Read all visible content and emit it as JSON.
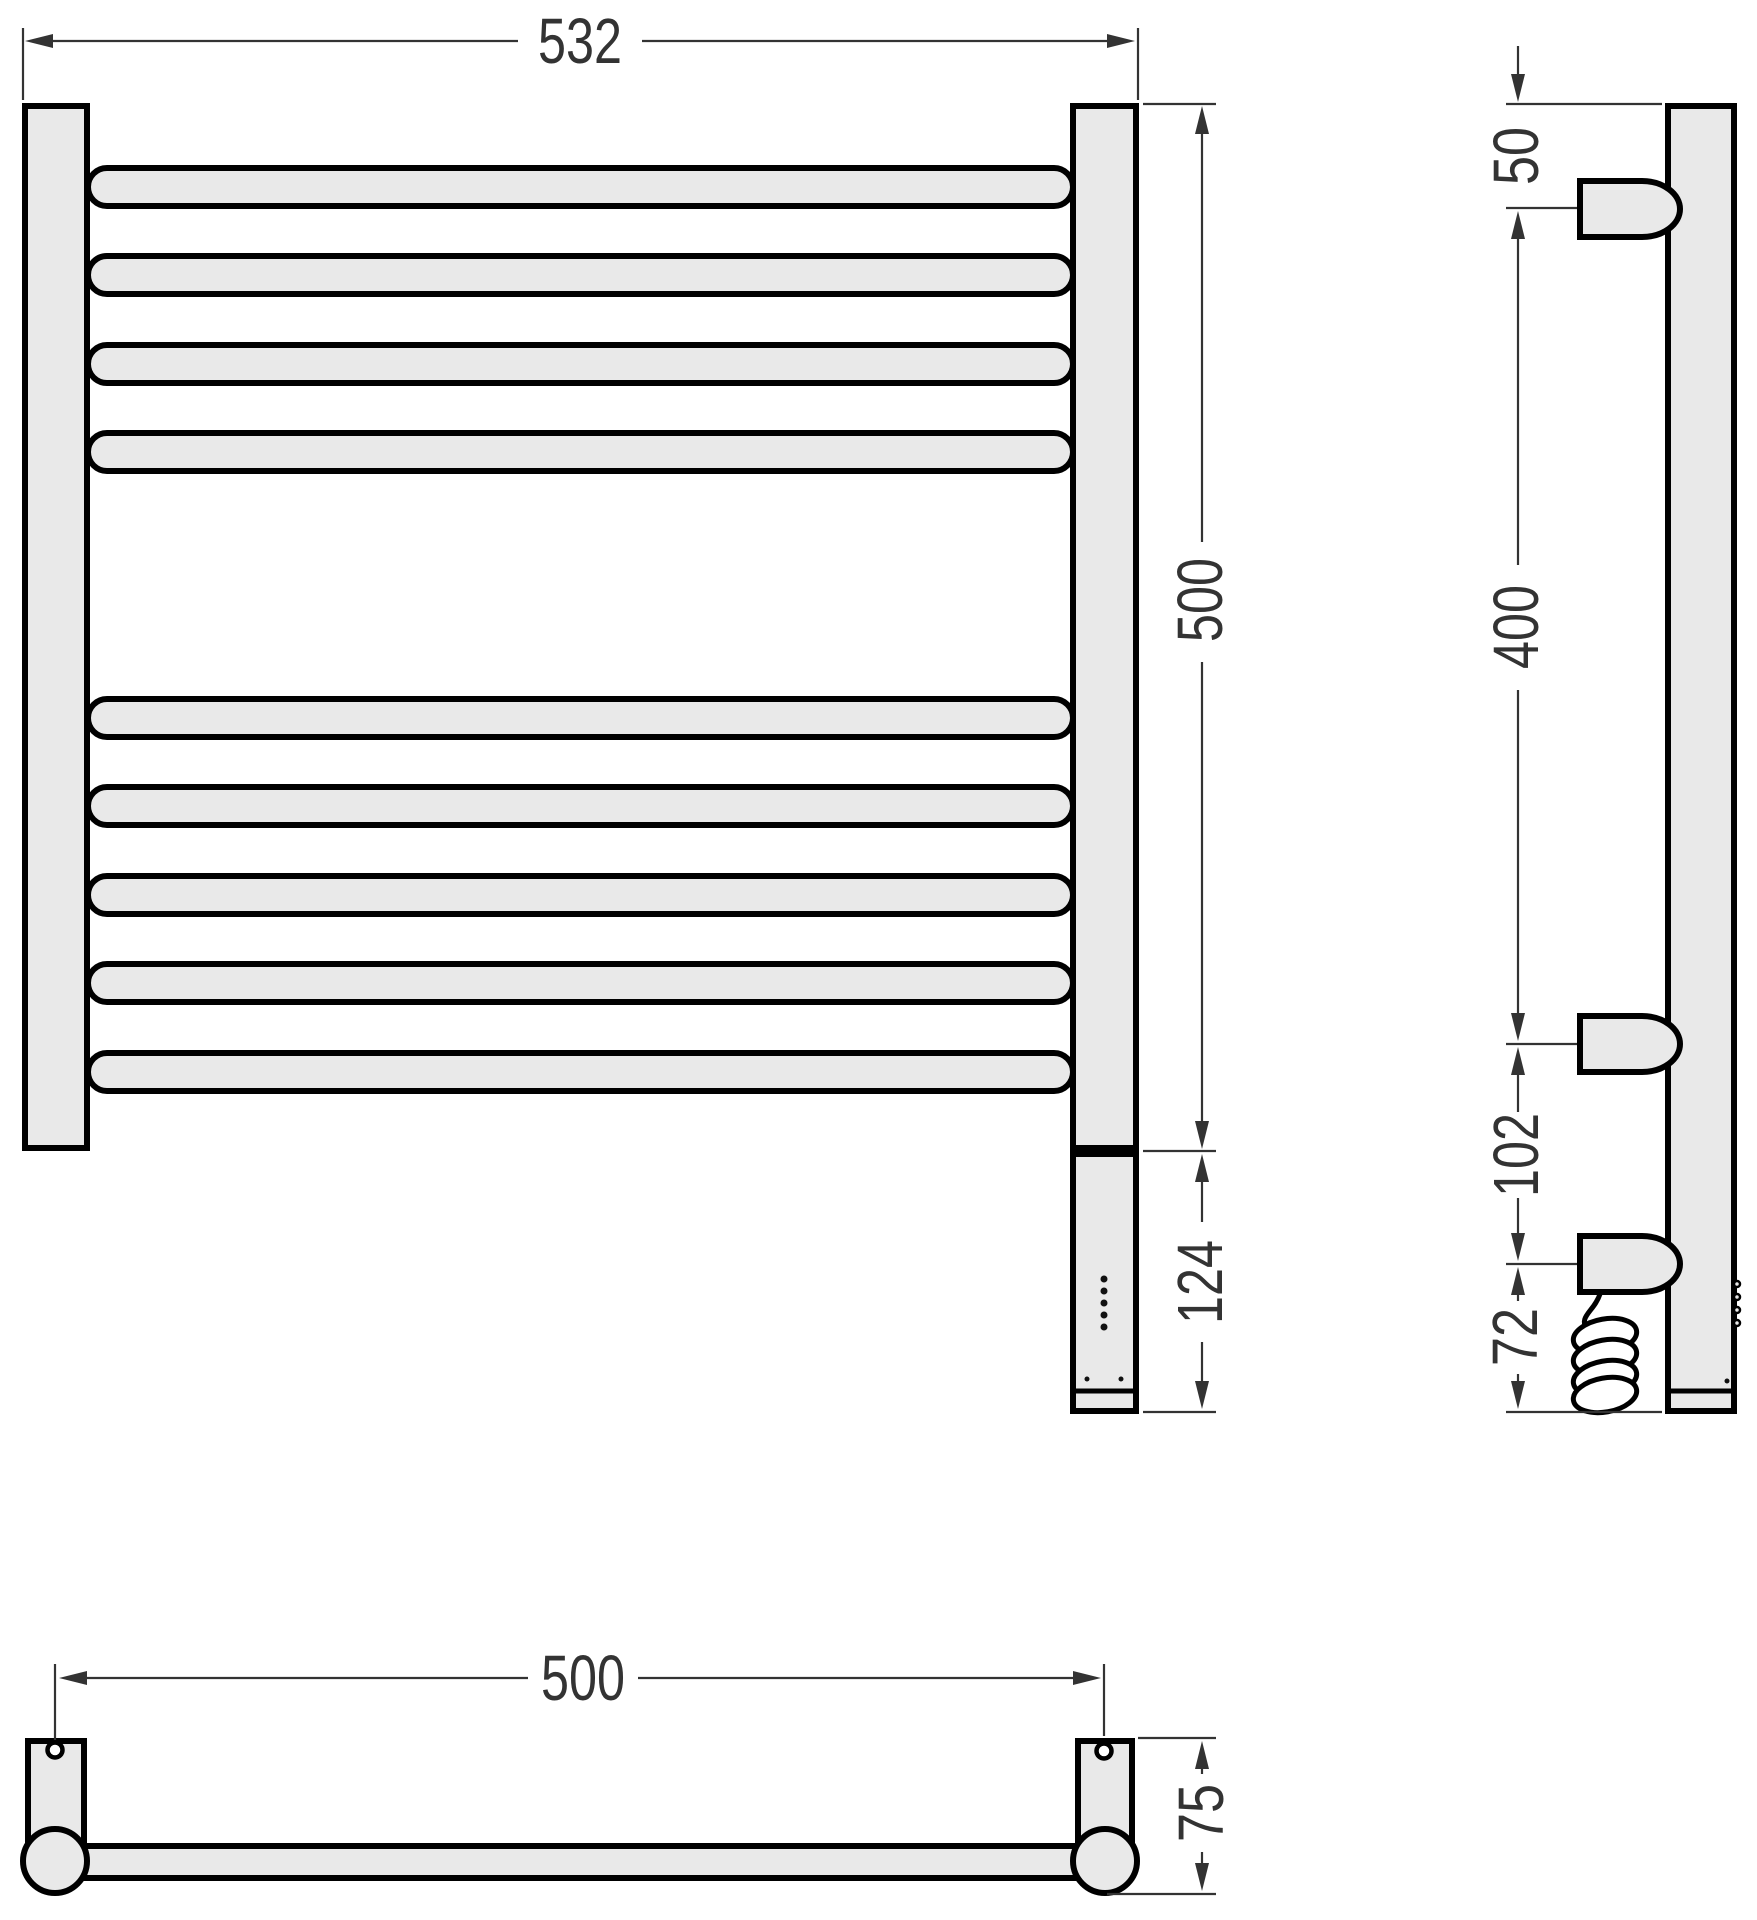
{
  "drawing": {
    "type": "technical-drawing",
    "subject": "electric heated towel rail — three orthographic views",
    "colors": {
      "background": "#ffffff",
      "outline": "#000000",
      "dim": "#333333",
      "fill": "#e9e9e9"
    },
    "views": {
      "front": {
        "rungs_top_group": 4,
        "rungs_bottom_group": 5,
        "led_dots": 5,
        "control_box": true
      },
      "side": {
        "wall_brackets": 2,
        "heating_element": true,
        "coiled_power_cable": true
      },
      "bottom": {
        "mounting_holes": 2,
        "end_posts": 2
      }
    },
    "dims": {
      "overall_width": "532",
      "rail_height": "500",
      "control_box_height": "124",
      "top_to_bracket": "50",
      "bracket_spacing": "400",
      "bracket_to_element": "102",
      "element_to_end": "72",
      "mount_centers": "500",
      "depth": "75"
    }
  }
}
